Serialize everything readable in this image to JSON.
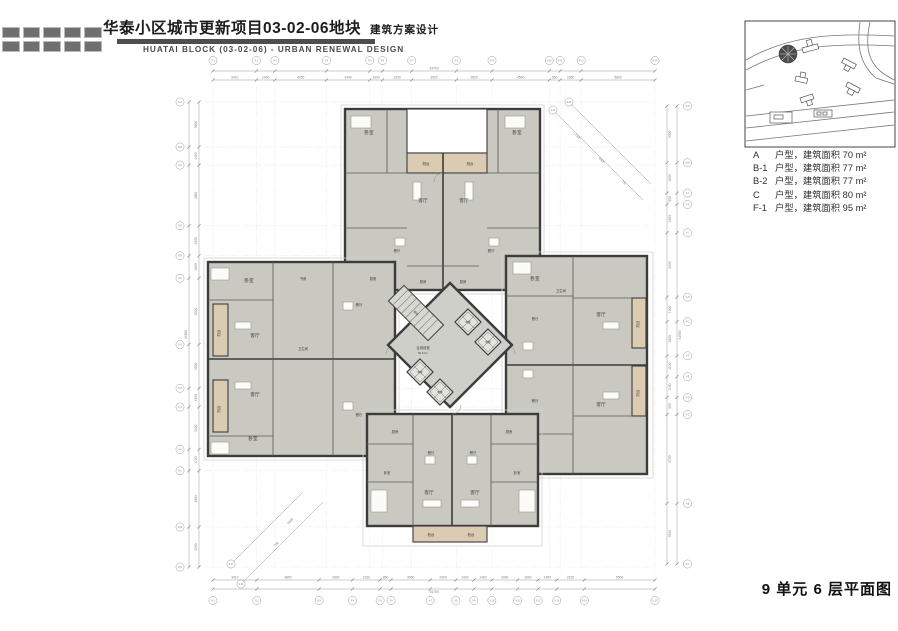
{
  "header": {
    "title_cn": "华泰小区城市更新项目03-02-06地块",
    "title_suffix": "建筑方案设计",
    "title_en": "HUATAI BLOCK (03-02-06) - URBAN RENEWAL DESIGN"
  },
  "legend": {
    "items": [
      {
        "code": "A",
        "text": "户型，建筑面积 70 m²"
      },
      {
        "code": "B-1",
        "text": "户型，建筑面积 77 m²"
      },
      {
        "code": "B-2",
        "text": "户型，建筑面积 77 m²"
      },
      {
        "code": "C",
        "text": "户型，建筑面积 80 m²"
      },
      {
        "code": "F-1",
        "text": "户型，建筑面积 95 m²"
      }
    ]
  },
  "footer": {
    "caption": "9 单元 6 层平面图"
  },
  "plan": {
    "rooms": {
      "living": "客厅",
      "dining": "餐厅",
      "bedroom": "卧室",
      "kitchen": "厨房",
      "balcony": "阳台",
      "study": "书房",
      "bath": "卫生间"
    },
    "core": {
      "hall": "合用前室",
      "hall_area": "65.17m²",
      "elevator": "电梯",
      "stair": "楼梯"
    },
    "dims": {
      "top": {
        "values": [
          3410,
          1450,
          4050,
          3400,
          1000,
          2300,
          3500,
          2800,
          4500,
          850,
          1650,
          5800
        ],
        "total": "34700",
        "bubbles": [
          "9-1",
          "9-2",
          "9-3",
          "9-4",
          "9-5",
          "9-6",
          "9-7",
          "9-8",
          "9-9",
          "9-10",
          "9-11",
          "9-12",
          "9-13"
        ]
      },
      "bottom": {
        "values": [
          3410,
          4850,
          2600,
          2150,
          850,
          3050,
          2000,
          1400,
          1400,
          2000,
          1600,
          1450,
          2150,
          5500
        ],
        "total": "34700",
        "bubbles": [
          "9-1",
          "9-2",
          "9-3",
          "9-4",
          "9-5",
          "9-6",
          "9-7",
          "9-8",
          "9-9",
          "9-10",
          "9-11",
          "9-12",
          "9-13",
          "9-14",
          "9-15"
        ]
      },
      "left": {
        "values": [
          3600,
          1450,
          4850,
          2400,
          1800,
          5300,
          3500,
          1500,
          3400,
          1700,
          4500,
          3200
        ],
        "total": "34900",
        "bubbles": [
          "9-A",
          "9-B",
          "9-C",
          "9-D",
          "9-E",
          "9-F",
          "9-G",
          "9-H",
          "9-J",
          "9-K",
          "9-L",
          "9-M",
          "9-N"
        ]
      },
      "right": {
        "values": [
          3000,
          1600,
          600,
          1500,
          3400,
          1300,
          1800,
          1100,
          1100,
          900,
          4700,
          3200
        ],
        "total": "34900",
        "bubbles": [
          "9-N",
          "9-M",
          "9-L",
          "9-K",
          "9-J",
          "9-H",
          "9-G",
          "9-F",
          "9-E",
          "9-D",
          "9-C",
          "9-B",
          "9-A"
        ]
      }
    },
    "corner": {
      "tr": [
        "1500",
        "4800",
        "700"
      ],
      "bl": [
        "700",
        "4800"
      ],
      "tr_bubbles": [
        "9-14",
        "9-15"
      ],
      "bl_bubbles": [
        "9-16",
        "9-17"
      ]
    }
  },
  "colors": {
    "wall": "#3c3c3c",
    "room_fill": "#c9c9c2",
    "balcony_fill": "#dbcbb2",
    "header_bar": "#4e4e4e"
  }
}
